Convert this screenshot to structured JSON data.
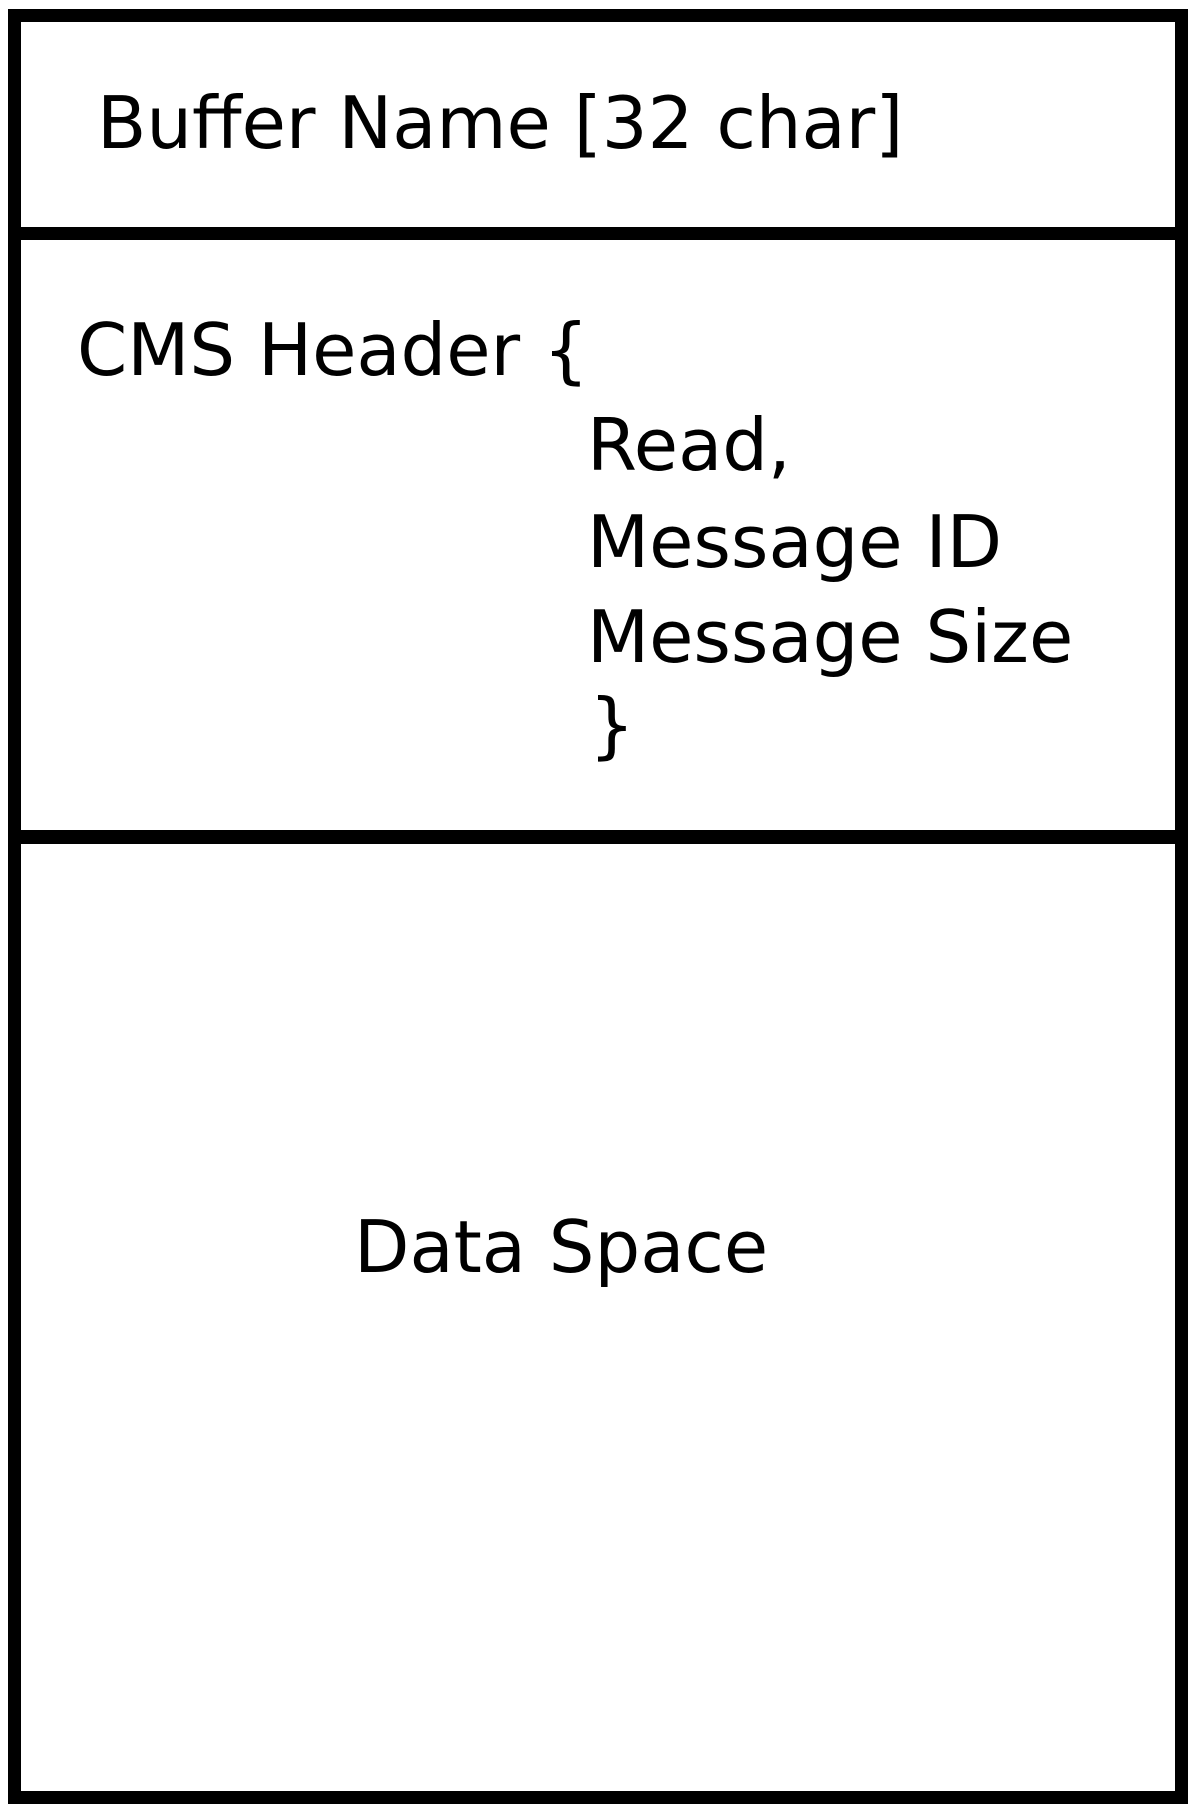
{
  "diagram": {
    "buffer_name": "Buffer Name [32 char]",
    "cms_header": {
      "open": "CMS Header {",
      "fields": [
        "Read,",
        "Message ID",
        "Message Size"
      ],
      "close": "}"
    },
    "data_space": "Data Space",
    "colors": {
      "line": "#000000",
      "background": "#ffffff",
      "text": "#000000"
    }
  }
}
